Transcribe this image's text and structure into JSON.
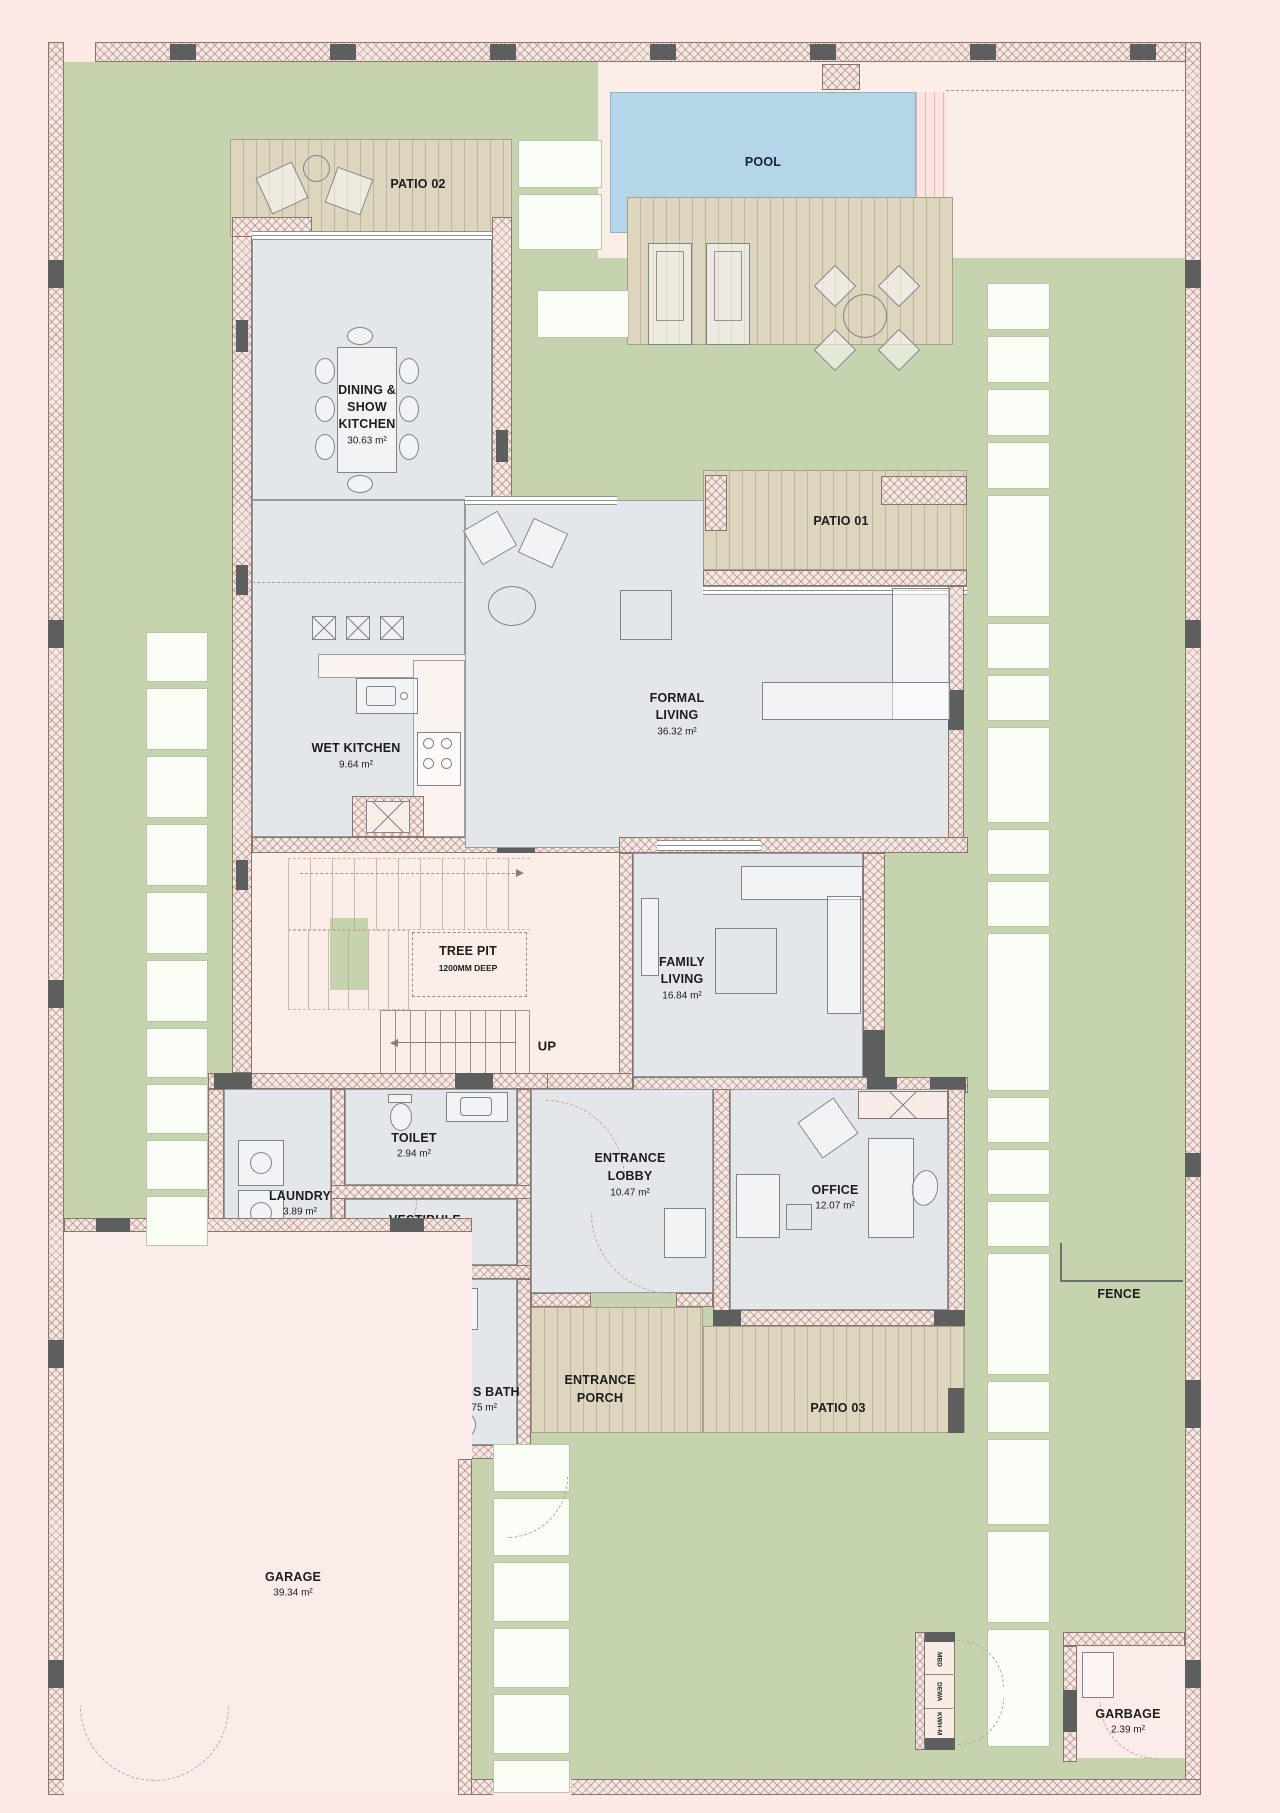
{
  "labels": {
    "pool": "POOL",
    "patio01": "PATIO 01",
    "patio02": "PATIO 02",
    "patio03": "PATIO 03",
    "entrance_porch_l1": "ENTRANCE",
    "entrance_porch_l2": "PORCH",
    "tree_pit_l1": "TREE PIT",
    "tree_pit_l2": "1200MM DEEP",
    "up": "UP",
    "fence": "FENCE",
    "meter_1": "MBD",
    "meter_2": "DEWA",
    "meter_3": "KWH-M"
  },
  "rooms": {
    "dining": {
      "l1": "DINING &",
      "l2": "SHOW",
      "l3": "KITCHEN",
      "area": "30.63 m²"
    },
    "wet_kitchen": {
      "name": "WET KITCHEN",
      "area": "9.64 m²"
    },
    "formal_living": {
      "l1": "FORMAL",
      "l2": "LIVING",
      "area": "36.32 m²"
    },
    "family_living": {
      "l1": "FAMILY",
      "l2": "LIVING",
      "area": "16.84 m²"
    },
    "toilet": {
      "name": "TOILET",
      "area": "2.94 m²"
    },
    "laundry": {
      "name": "LAUNDRY",
      "area": "3.89 m²"
    },
    "vestibule": {
      "name": "VESTIBULE",
      "area": "2.05 m²"
    },
    "entrance_lobby": {
      "l1": "ENTRANCE",
      "l2": "LOBBY",
      "area": "10.47 m²"
    },
    "office": {
      "name": "OFFICE",
      "area": "12.07 m²"
    },
    "maids_room": {
      "name": "MAIDS ROOM",
      "area": "6.09 m²"
    },
    "maids_bath": {
      "name": "MAIDS BATH",
      "area": "3.75 m²"
    },
    "garage": {
      "name": "GARAGE",
      "area": "39.34 m²"
    },
    "garbage": {
      "name": "GARBAGE",
      "area": "2.39 m²"
    }
  },
  "colors": {
    "background": "#fdeae6",
    "garden": "#c5d3af",
    "deck": "#ded5bf",
    "pool": "#b5d6e8",
    "interior": "#e3e7ea",
    "circulation": "#fbeee9",
    "wall_dark": "#5d5f5e"
  }
}
